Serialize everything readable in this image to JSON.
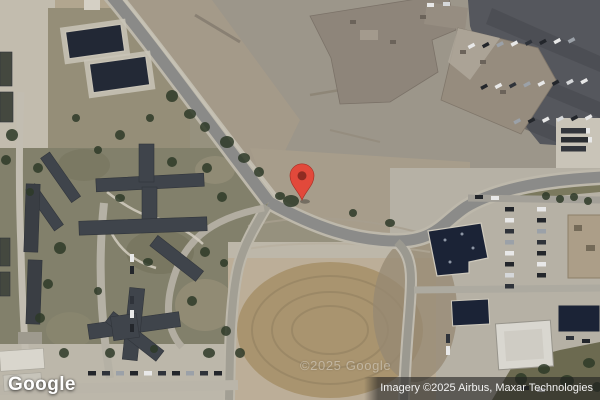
{
  "branding": {
    "logo_text": "Google"
  },
  "attribution": {
    "text": "Imagery ©2025 Airbus, Maxar Technologies"
  },
  "watermark": {
    "text": "©2025 Google"
  },
  "marker": {
    "x": 302,
    "y": 200,
    "fill": "#E2493B",
    "inner_fill": "#8F2B22"
  }
}
